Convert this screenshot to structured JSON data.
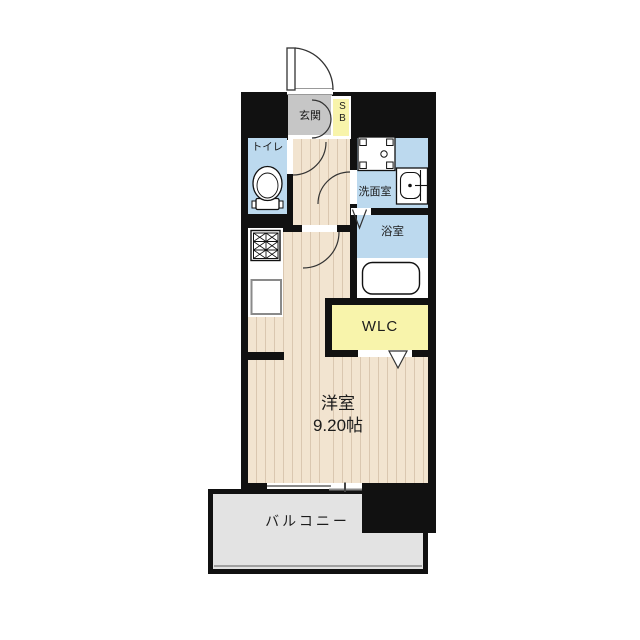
{
  "colors": {
    "wall": "#111111",
    "wood_floor": "#f2e4d0",
    "wood_stripe": "#dac7b0",
    "wet_area_blue": "#bcd9ee",
    "closet_yellow": "#f8f4ab",
    "entrance_gray": "#c6c6c6",
    "balcony_gray": "#e3e3e3",
    "background": "#ffffff"
  },
  "rooms": {
    "entrance": {
      "label": "玄関"
    },
    "shoe_box": {
      "label": "SB"
    },
    "toilet": {
      "label": "トイレ"
    },
    "washroom": {
      "label": "洗面室"
    },
    "bathroom": {
      "label": "浴室"
    },
    "walk_in_closet": {
      "label": "WLC"
    },
    "western_room": {
      "label": "洋室",
      "size": "9.20帖"
    },
    "balcony": {
      "label": "バルコニー"
    }
  },
  "fixtures": {
    "icons": [
      "entrance-door-swing-icon",
      "shoe-cabinet-doors-icon",
      "toilet-icon",
      "washing-machine-pan-icon",
      "wash-basin-icon",
      "bathtub-icon",
      "gas-stove-icon",
      "kitchen-sink-icon",
      "bathroom-folding-door-icon",
      "closet-folding-door-icon",
      "sliding-window-icon",
      "door-swing-icon"
    ]
  }
}
